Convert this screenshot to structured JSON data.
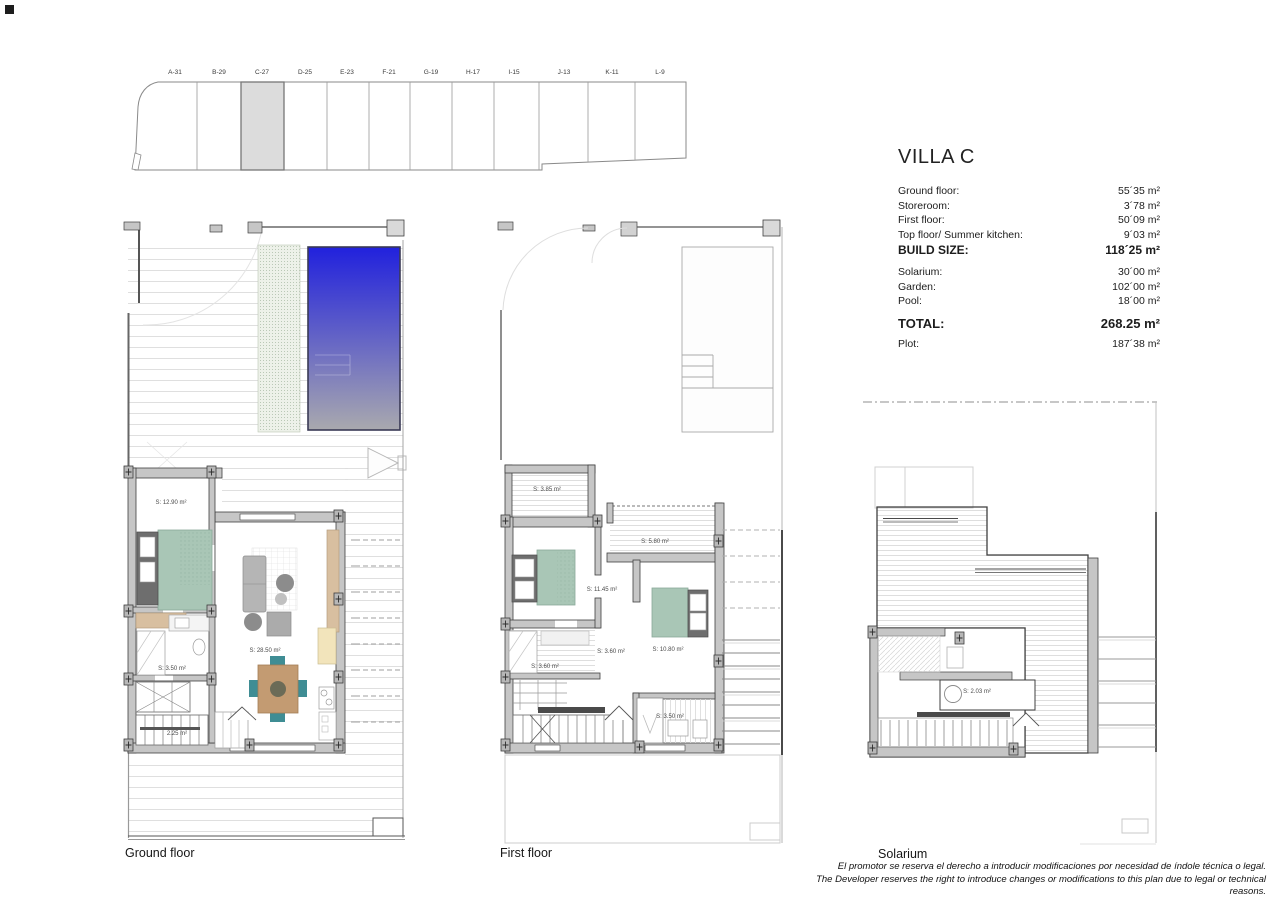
{
  "site_plan": {
    "lots": [
      {
        "label": "A-31"
      },
      {
        "label": "B-29"
      },
      {
        "label": "C-27"
      },
      {
        "label": "D-25"
      },
      {
        "label": "E-23"
      },
      {
        "label": "F-21"
      },
      {
        "label": "G-19"
      },
      {
        "label": "H-17"
      },
      {
        "label": "I-15"
      },
      {
        "label": "J-13"
      },
      {
        "label": "K-11"
      },
      {
        "label": "L-9"
      }
    ],
    "highlighted_lot": "C-27"
  },
  "spec_panel": {
    "title": "VILLA C",
    "rows": [
      {
        "label": "Ground floor:",
        "value": "55´35 m²"
      },
      {
        "label": "Storeroom:",
        "value": "3´78 m²"
      },
      {
        "label": "First floor:",
        "value": "50´09 m²"
      },
      {
        "label": "Top floor/ Summer kitchen:",
        "value": "9´03 m²"
      },
      {
        "label": "BUILD SIZE:",
        "value": "118´25 m²"
      },
      {
        "label": "Solarium:",
        "value": "30´00 m²"
      },
      {
        "label": "Garden:",
        "value": "102´00 m²"
      },
      {
        "label": "Pool:",
        "value": "18´00 m²"
      },
      {
        "label": "TOTAL:",
        "value": "268.25 m²"
      },
      {
        "label": "Plot:",
        "value": "187´38 m²"
      }
    ]
  },
  "floors": {
    "ground": {
      "caption": "Ground floor",
      "room_labels": [
        {
          "text": "S: 12.90 m²"
        },
        {
          "text": "S: 28.50 m²"
        },
        {
          "text": "S: 3.50 m²"
        },
        {
          "text": "2.25 m²"
        }
      ]
    },
    "first": {
      "caption": "First floor",
      "room_labels": [
        {
          "text": "S: 3.85 m²"
        },
        {
          "text": "S: 5.80 m²"
        },
        {
          "text": "S: 11.45 m²"
        },
        {
          "text": "S: 3.60 m²"
        },
        {
          "text": "S: 10.80 m²"
        },
        {
          "text": "S: 3.60 m²"
        },
        {
          "text": "S: 3.50 m²"
        }
      ]
    },
    "solarium": {
      "caption": "Solarium",
      "room_labels": [
        {
          "text": "S: 2.03 m²"
        }
      ]
    }
  },
  "disclaimer": {
    "line_es": "El promotor se reserva el derecho a introducir modificaciones por necesidad de índole técnica o legal.",
    "line_en": "The Developer reserves the right to introduce changes or modifications to this plan due to legal or technical reasons."
  },
  "colors": {
    "pool_top": "#2121dd",
    "pool_bottom": "#a9a9ae",
    "lawn": "#edf1e9",
    "bed": "#a9c6b6",
    "wood": "#d8bfa0",
    "kitchen_cabinet": "#f2e4bb",
    "chair_teal": "#3f8d94",
    "sofa_gray": "#b5b5b5",
    "wall_fill": "#c6c6c6",
    "lot_highlight": "#dcdcdc"
  }
}
